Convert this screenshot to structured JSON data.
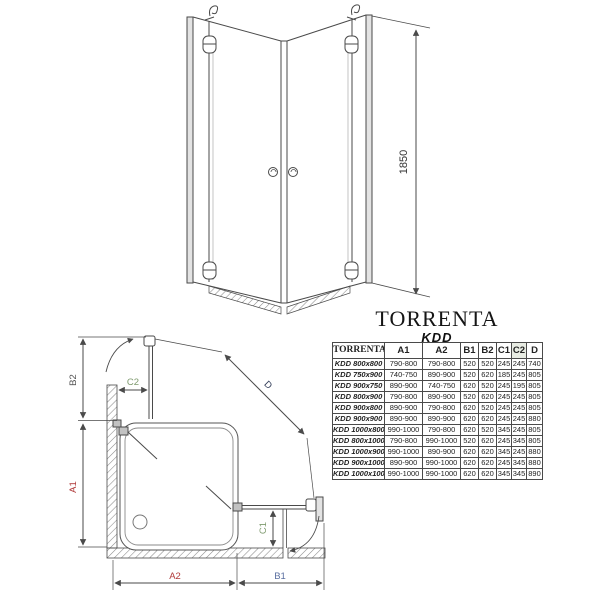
{
  "title": {
    "brand": "TORRENTA",
    "model": "KDD"
  },
  "front_view": {
    "height_label": "1850"
  },
  "plan_view": {
    "labels": {
      "a1": "A1",
      "a2": "A2",
      "b1": "B1",
      "b2": "B2",
      "c1": "C1",
      "c2": "C2",
      "d": "D"
    }
  },
  "table": {
    "header": {
      "name": "TORRENTA",
      "a1": "A1",
      "a2": "A2",
      "b1": "B1",
      "b2": "B2",
      "c1": "C1",
      "c2": "C2",
      "d": "D"
    },
    "rows": [
      {
        "model": "KDD 800x800",
        "a1": "790-800",
        "a2": "790-800",
        "b1": "520",
        "b2": "520",
        "c1": "245",
        "c2": "245",
        "d": "740"
      },
      {
        "model": "KDD 750x900",
        "a1": "740-750",
        "a2": "890-900",
        "b1": "520",
        "b2": "620",
        "c1": "185",
        "c2": "245",
        "d": "805"
      },
      {
        "model": "KDD 900x750",
        "a1": "890-900",
        "a2": "740-750",
        "b1": "620",
        "b2": "520",
        "c1": "245",
        "c2": "195",
        "d": "805"
      },
      {
        "model": "KDD 800x900",
        "a1": "790-800",
        "a2": "890-900",
        "b1": "520",
        "b2": "620",
        "c1": "245",
        "c2": "245",
        "d": "805"
      },
      {
        "model": "KDD 900x800",
        "a1": "890-900",
        "a2": "790-800",
        "b1": "620",
        "b2": "520",
        "c1": "245",
        "c2": "245",
        "d": "805"
      },
      {
        "model": "KDD 900x900",
        "a1": "890-900",
        "a2": "890-900",
        "b1": "620",
        "b2": "620",
        "c1": "245",
        "c2": "245",
        "d": "880"
      },
      {
        "model": "KDD 1000x800",
        "a1": "990-1000",
        "a2": "790-800",
        "b1": "620",
        "b2": "520",
        "c1": "345",
        "c2": "245",
        "d": "805"
      },
      {
        "model": "KDD 800x1000",
        "a1": "790-800",
        "a2": "990-1000",
        "b1": "520",
        "b2": "620",
        "c1": "245",
        "c2": "345",
        "d": "805"
      },
      {
        "model": "KDD 1000x900",
        "a1": "990-1000",
        "a2": "890-900",
        "b1": "620",
        "b2": "620",
        "c1": "345",
        "c2": "245",
        "d": "880"
      },
      {
        "model": "KDD 900x1000",
        "a1": "890-900",
        "a2": "990-1000",
        "b1": "620",
        "b2": "620",
        "c1": "245",
        "c2": "345",
        "d": "880"
      },
      {
        "model": "KDD 1000x1000",
        "a1": "990-1000",
        "a2": "990-1000",
        "b1": "620",
        "b2": "620",
        "c1": "345",
        "c2": "345",
        "d": "890"
      }
    ]
  },
  "colors": {
    "line": "#4a4a4a",
    "dim_red": "#b03a3a",
    "dim_green": "#7e9a6e",
    "dim_blue": "#5a6fa0",
    "dim_navy": "#2f3a56",
    "header_green": "#87997d"
  }
}
